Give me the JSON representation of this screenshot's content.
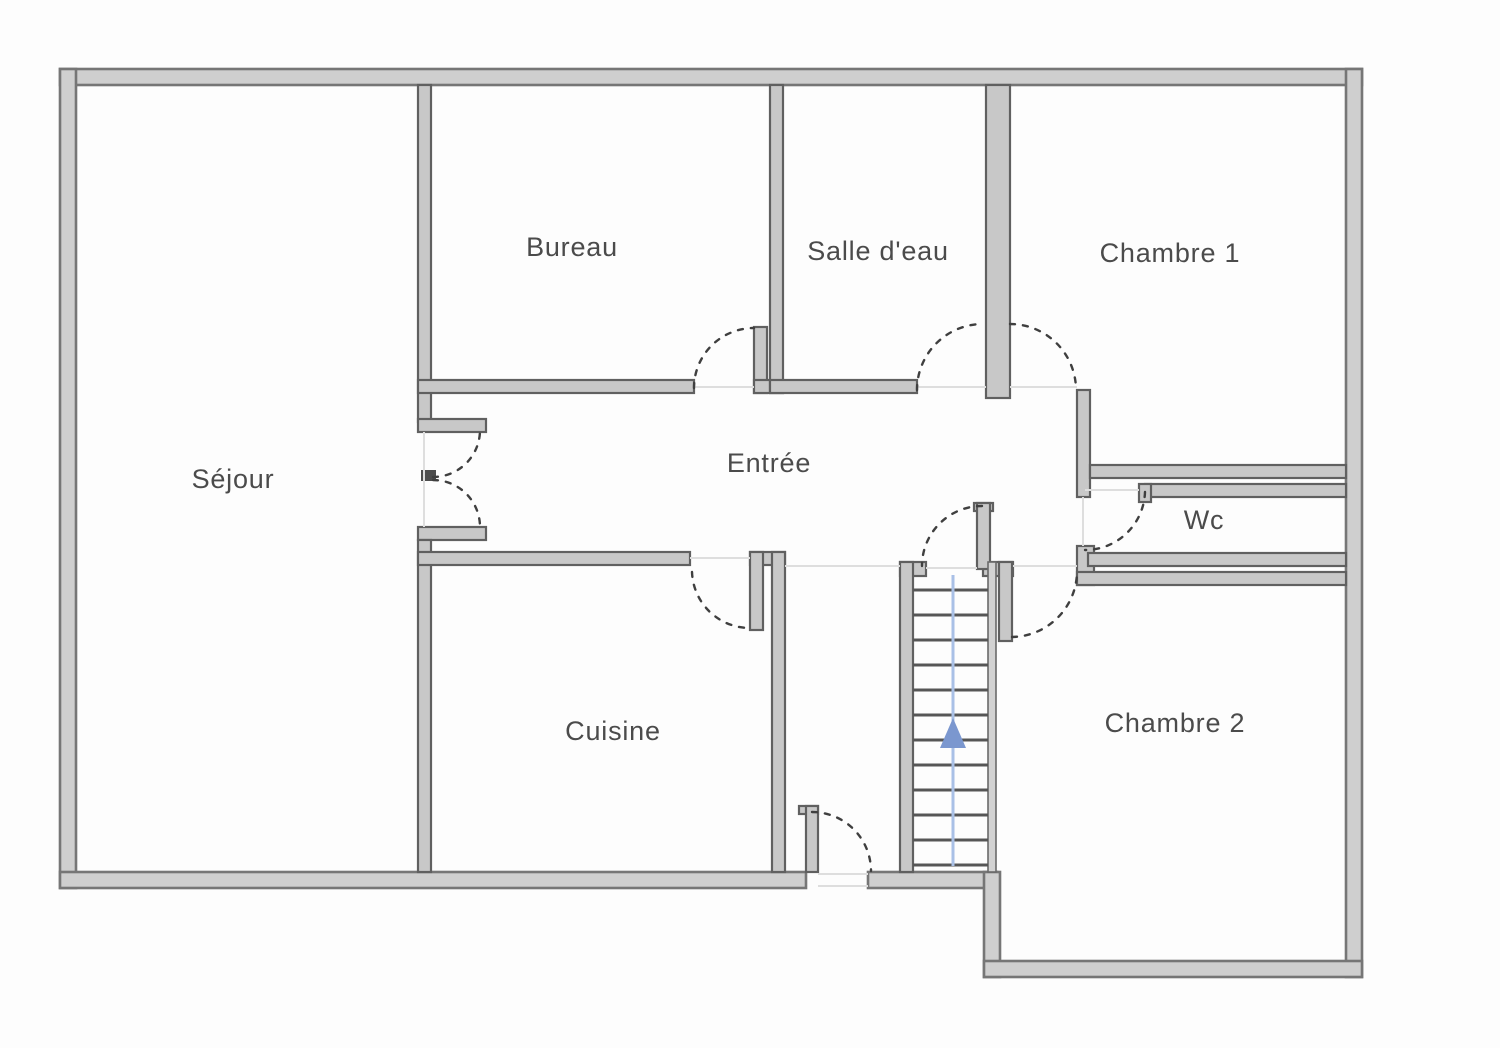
{
  "plan": {
    "type": "floor-plan",
    "language": "fr",
    "rooms": [
      {
        "name": "Séjour"
      },
      {
        "name": "Bureau"
      },
      {
        "name": "Salle d'eau"
      },
      {
        "name": "Chambre 1"
      },
      {
        "name": "Entrée"
      },
      {
        "name": "Wc"
      },
      {
        "name": "Cuisine"
      },
      {
        "name": "Chambre 2"
      }
    ],
    "stairs": {
      "direction_icon": "up-arrow",
      "tread_count": 12
    },
    "colors": {
      "background": "#fdfdfd",
      "exterior_wall_fill": "#cfcfcf",
      "exterior_wall_edge": "#767676",
      "interior_wall_fill": "#c8c8c8",
      "interior_wall_edge": "#606060",
      "door_arc": "#3f3f3f",
      "opening_reference_line": "#dedede",
      "stair_tread": "#565656",
      "walking_line_blue": "#a9c0e6",
      "arrow_blue": "#7b97cf",
      "label_text": "#4b4b4b"
    }
  }
}
